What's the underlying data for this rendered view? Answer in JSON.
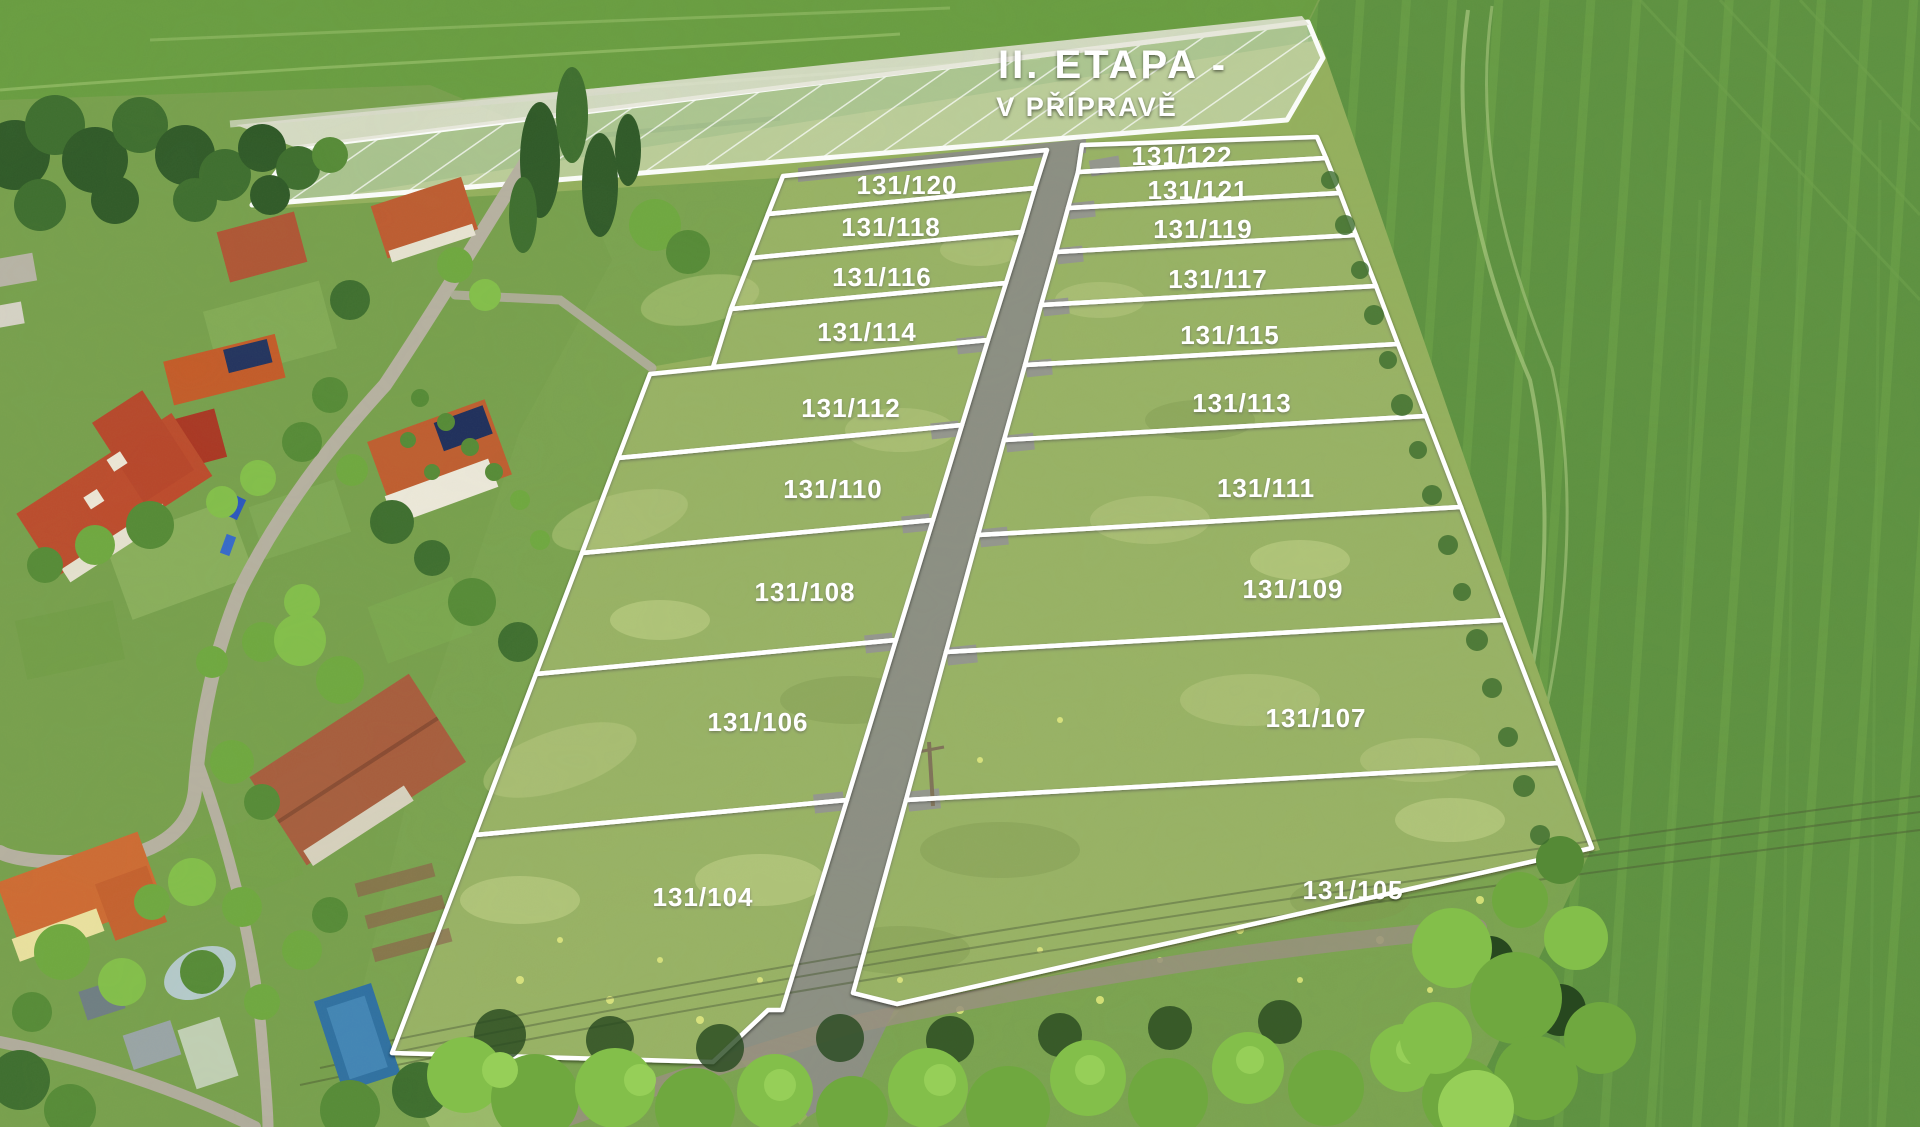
{
  "banner": {
    "line1": "II. ETAPA -",
    "line2": "V PŘÍPRAVĚ"
  },
  "parcels": {
    "left_column": [
      "131/120",
      "131/118",
      "131/116",
      "131/114",
      "131/112",
      "131/110",
      "131/108",
      "131/106",
      "131/104"
    ],
    "right_column": [
      "131/122",
      "131/121",
      "131/119",
      "131/117",
      "131/115",
      "131/113",
      "131/111",
      "131/109",
      "131/107",
      "131/105"
    ]
  },
  "colors": {
    "boundary_white": "#ffffff",
    "road_gray": "#8c8e84",
    "label_text": "#ffffff",
    "hatch_area_tint": "#ffffff"
  }
}
